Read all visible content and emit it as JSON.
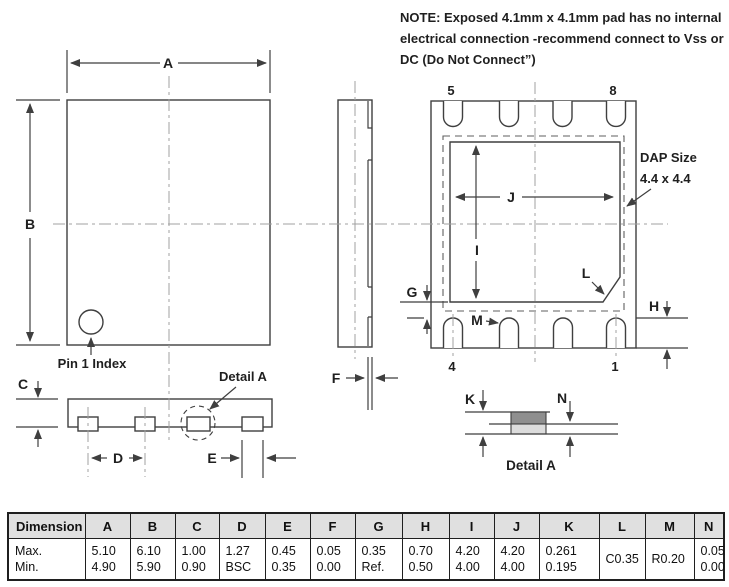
{
  "note": {
    "line1": "NOTE:  Exposed 4.1mm x 4.1mm pad has no internal",
    "line2": "electrical connection -recommend connect to Vss or",
    "line3": "DC (Do Not Connect”)"
  },
  "drawing": {
    "top_view": {
      "dim_a": "A",
      "dim_b": "B",
      "pin1_index": "Pin 1 Index"
    },
    "side_view": {
      "dim_c": "C",
      "detail_a": "Detail A",
      "dim_d": "D",
      "dim_e": "E"
    },
    "profile_view": {
      "dim_f": "F"
    },
    "bottom_view": {
      "pin5": "5",
      "pin8": "8",
      "pin4": "4",
      "pin1": "1",
      "dim_j": "J",
      "dim_i": "I",
      "dim_l": "L",
      "dim_m": "M",
      "dim_g": "G",
      "dim_h": "H",
      "dap_size": "DAP Size",
      "dap_dims": "4.4 x 4.4"
    },
    "detail_view": {
      "dim_k": "K",
      "dim_n": "N",
      "caption": "Detail A"
    }
  },
  "table": {
    "header": [
      "Dimension",
      "A",
      "B",
      "C",
      "D",
      "E",
      "F",
      "G",
      "H",
      "I",
      "J",
      "K",
      "L",
      "M",
      "N"
    ],
    "rows": {
      "label": {
        "max": "Max.",
        "min": "Min."
      },
      "A": {
        "max": "5.10",
        "min": "4.90"
      },
      "B": {
        "max": "6.10",
        "min": "5.90"
      },
      "C": {
        "max": "1.00",
        "min": "0.90"
      },
      "D": {
        "max": "1.27",
        "min": "BSC"
      },
      "E": {
        "max": "0.45",
        "min": "0.35"
      },
      "F": {
        "max": "0.05",
        "min": "0.00"
      },
      "G": {
        "max": "0.35",
        "min": "Ref."
      },
      "H": {
        "max": "0.70",
        "min": "0.50"
      },
      "I": {
        "max": "4.20",
        "min": "4.00"
      },
      "J": {
        "max": "4.20",
        "min": "4.00"
      },
      "K": {
        "max": "0.261",
        "min": "0.195"
      },
      "L": {
        "single": "C0.35"
      },
      "M": {
        "single": "R0.20"
      },
      "N": {
        "max": "0.05",
        "min": "0.00"
      }
    }
  },
  "colors": {
    "line": "#3f3f3f",
    "centerline": "#a0a0a0",
    "pad_dark": "#8f8f8f",
    "pad_light": "#dcdcdc",
    "table_header_bg": "#e0e0e0",
    "text": "#1f1f1f"
  }
}
